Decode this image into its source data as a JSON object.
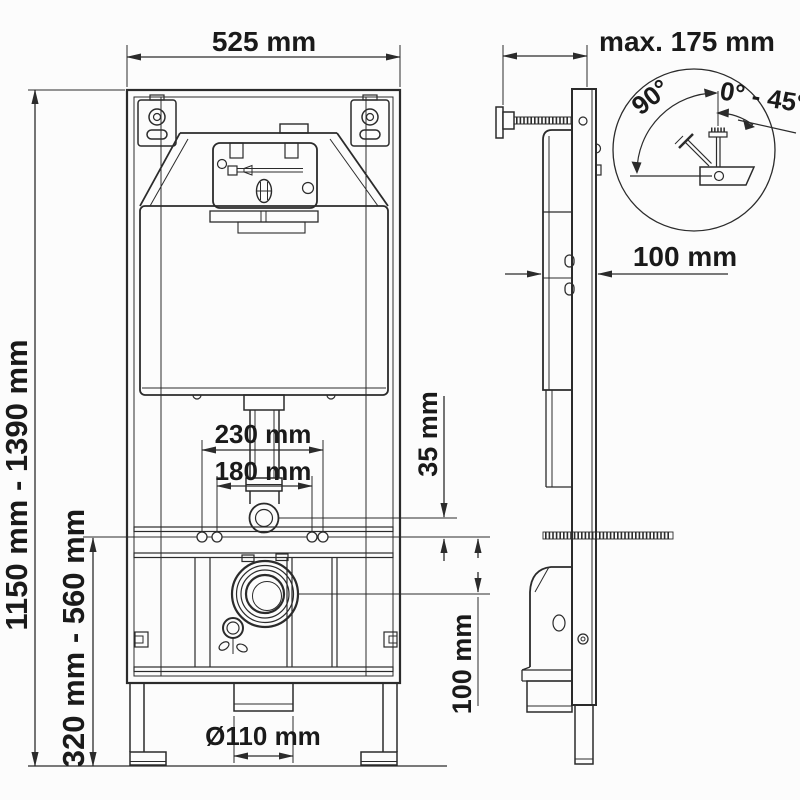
{
  "colors": {
    "line": "#2b2b2b",
    "text": "#1a1a1a",
    "background": "#fcfcfc"
  },
  "front_view": {
    "width_label": "525 mm",
    "height_range_label": "1150 mm - 1390 mm",
    "lower_range_label": "320 mm - 560 mm",
    "bolt_outer_label": "230 mm",
    "bolt_inner_label": "180 mm",
    "outlet_diameter_label": "Ø110 mm"
  },
  "side_view": {
    "wall_distance_label": "max. 175 mm",
    "depth_label": "100 mm",
    "inlet_offset_label": "35 mm",
    "stud_to_drain_label": "100 mm"
  },
  "detail_view": {
    "swing_angle_label": "90°",
    "tilt_range_label": "0° - 45°"
  }
}
